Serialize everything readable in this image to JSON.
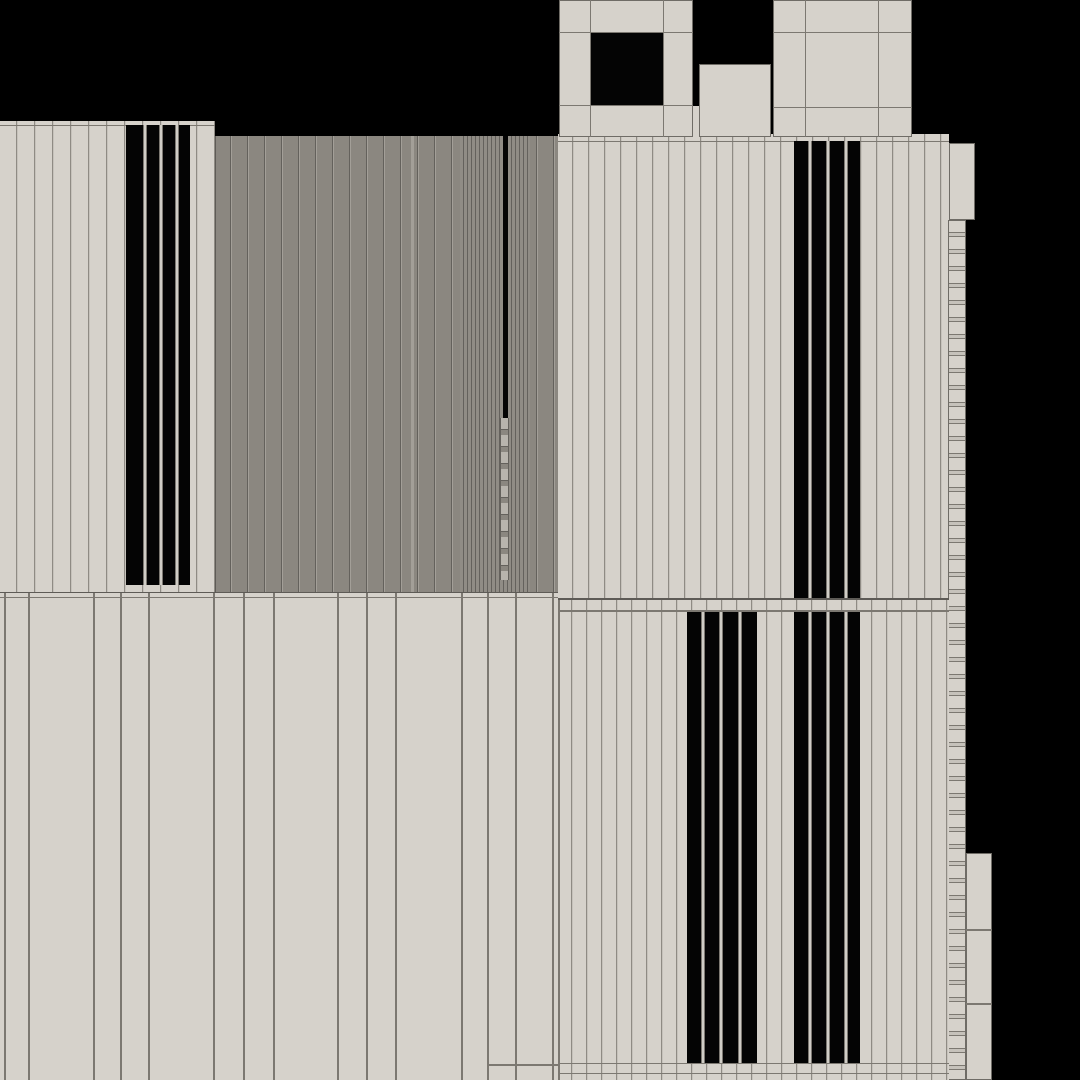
{
  "palette": {
    "bg": "#000000",
    "black": "#040404",
    "light": "#d6d2cb",
    "plank_seam": "#8f8b84",
    "plank_hi": "#c6c2bb",
    "seam_mid": "#7c7871",
    "seam_strong": "#5e5b56",
    "gray": "#8b8780",
    "gray_dense": "#908c85",
    "gray_seam": "#64615c",
    "gray_hi": "#a39f98",
    "tab": "#b8b4ad",
    "divider": "#cfccc5",
    "edge": "#6f6c66"
  },
  "scene": {
    "width": 1080,
    "height": 1080,
    "background": "bg",
    "regions": [
      {
        "name": "facade-upper-left",
        "x": 0,
        "y": 121,
        "w": 215,
        "h": 471,
        "pattern": "vplanks",
        "base": "light",
        "seam": "plank_seam",
        "hi": "plank_hi",
        "period": 18,
        "hlines": [
          {
            "y": 4,
            "h": 1,
            "color": "seam_mid"
          }
        ]
      },
      {
        "name": "window-slats-upper-left",
        "x": 126,
        "y": 125,
        "w": 64,
        "h": 460,
        "pattern": "slats",
        "dividers": [
          [
            17,
            21
          ],
          [
            33,
            37
          ],
          [
            49,
            53
          ]
        ]
      },
      {
        "name": "facade-upper-middle-gray",
        "x": 215,
        "y": 136,
        "w": 343,
        "h": 456,
        "pattern": "vplanks",
        "base": "gray",
        "seam": "gray_seam",
        "hi": "gray_hi",
        "period": 17,
        "vlines": [
          {
            "x": 0,
            "w": 1,
            "color": "seam_strong"
          },
          {
            "x": 196,
            "w": 3,
            "color": "gray_hi"
          }
        ]
      },
      {
        "name": "plank-bundle-middle",
        "x": 460,
        "y": 136,
        "w": 70,
        "h": 456,
        "pattern": "dense",
        "base": "gray_dense",
        "seam": "gray_seam"
      },
      {
        "name": "door-seam-slot",
        "x": 503,
        "y": 136,
        "w": 5,
        "h": 282,
        "pattern": "black"
      },
      {
        "name": "hinge-strip",
        "x": 500,
        "y": 418,
        "w": 9,
        "h": 162,
        "pattern": "hinge"
      },
      {
        "name": "facade-upper-right",
        "x": 558,
        "y": 134,
        "w": 391,
        "h": 464,
        "pattern": "vplanks",
        "base": "light",
        "seam": "plank_seam",
        "hi": "plank_hi",
        "period": 16,
        "hlines": [
          {
            "y": 7,
            "h": 1,
            "color": "seam_mid"
          }
        ]
      },
      {
        "name": "window-slats-upper-right",
        "x": 794,
        "y": 141,
        "w": 66,
        "h": 457,
        "pattern": "slats",
        "dividers": [
          [
            14,
            18
          ],
          [
            32,
            36
          ],
          [
            50,
            54
          ]
        ]
      },
      {
        "name": "roof-block-a",
        "x": 559,
        "y": 0,
        "w": 134,
        "h": 137,
        "pattern": "flat",
        "base": "light",
        "edge": true,
        "vlines": [
          {
            "x": 31,
            "w": 1,
            "color": "seam_mid"
          },
          {
            "x": 104,
            "w": 1,
            "color": "seam_mid"
          }
        ],
        "hlines": [
          {
            "y": 32,
            "h": 1,
            "color": "seam_mid"
          },
          {
            "y": 105,
            "h": 1,
            "color": "seam_mid"
          }
        ],
        "rects": [
          {
            "name": "roof-block-a-opening",
            "x": 32,
            "y": 33,
            "w": 72,
            "h": 72,
            "color": "black"
          }
        ]
      },
      {
        "name": "roof-gap-fill",
        "x": 693,
        "y": 106,
        "w": 6,
        "h": 31,
        "pattern": "flat",
        "base": "light"
      },
      {
        "name": "roof-block-b",
        "x": 699,
        "y": 64,
        "w": 72,
        "h": 73,
        "pattern": "flat",
        "base": "light",
        "edge": true
      },
      {
        "name": "roof-block-c",
        "x": 773,
        "y": 0,
        "w": 139,
        "h": 137,
        "pattern": "flat",
        "base": "light",
        "edge": true,
        "vlines": [
          {
            "x": 32,
            "w": 1,
            "color": "seam_mid"
          },
          {
            "x": 105,
            "w": 1,
            "color": "seam_mid"
          }
        ],
        "hlines": [
          {
            "y": 32,
            "h": 1,
            "color": "seam_mid"
          },
          {
            "y": 107,
            "h": 1,
            "color": "seam_mid"
          }
        ]
      },
      {
        "name": "side-cap-block",
        "x": 949,
        "y": 143,
        "w": 26,
        "h": 77,
        "pattern": "flat",
        "base": "light",
        "edge": true
      },
      {
        "name": "side-ladder-strip",
        "x": 948,
        "y": 220,
        "w": 18,
        "h": 860,
        "pattern": "hladder",
        "edge": true
      },
      {
        "name": "side-appendix-block",
        "x": 966,
        "y": 853,
        "w": 26,
        "h": 227,
        "pattern": "flat",
        "base": "light",
        "edge": true,
        "hlines": [
          {
            "y": 76,
            "h": 2,
            "color": "seam_mid"
          },
          {
            "y": 150,
            "h": 2,
            "color": "seam_mid"
          }
        ]
      },
      {
        "name": "facade-lower-left",
        "x": 0,
        "y": 592,
        "w": 558,
        "h": 488,
        "pattern": "flat",
        "base": "light",
        "vlines": [
          {
            "x": 4
          },
          {
            "x": 28
          },
          {
            "x": 93
          },
          {
            "x": 120
          },
          {
            "x": 148
          },
          {
            "x": 213
          },
          {
            "x": 243
          },
          {
            "x": 273
          },
          {
            "x": 337
          },
          {
            "x": 366
          },
          {
            "x": 395
          },
          {
            "x": 461
          },
          {
            "x": 487
          },
          {
            "x": 515
          },
          {
            "x": 552
          }
        ],
        "hlines": [
          {
            "y": 0,
            "h": 1,
            "color": "seam_strong"
          },
          {
            "y": 5,
            "h": 1,
            "color": "seam_mid"
          },
          {
            "y": 472,
            "h": 2,
            "color": "seam_mid",
            "x": 487,
            "w": 71
          }
        ]
      },
      {
        "name": "facade-lower-right",
        "x": 558,
        "y": 598,
        "w": 391,
        "h": 482,
        "pattern": "vplanks",
        "base": "light",
        "seam": "plank_seam",
        "hi": "plank_hi",
        "period": 15,
        "vlines": [
          {
            "x": 0,
            "w": 2,
            "color": "seam_mid"
          }
        ],
        "hlines": [
          {
            "y": 0,
            "h": 2,
            "color": "seam_strong"
          },
          {
            "y": 12,
            "h": 2,
            "color": "seam_mid"
          },
          {
            "y": 465,
            "h": 1,
            "color": "seam_mid"
          },
          {
            "y": 475,
            "h": 1,
            "color": "seam_mid"
          }
        ]
      },
      {
        "name": "window-slats-lower-a",
        "x": 687,
        "y": 612,
        "w": 70,
        "h": 451,
        "pattern": "slats",
        "dividers": [
          [
            14,
            18
          ],
          [
            32,
            36
          ],
          [
            51,
            55
          ]
        ]
      },
      {
        "name": "window-slats-lower-b",
        "x": 794,
        "y": 612,
        "w": 66,
        "h": 451,
        "pattern": "slats",
        "dividers": [
          [
            14,
            18
          ],
          [
            32,
            36
          ],
          [
            50,
            54
          ]
        ]
      }
    ]
  }
}
